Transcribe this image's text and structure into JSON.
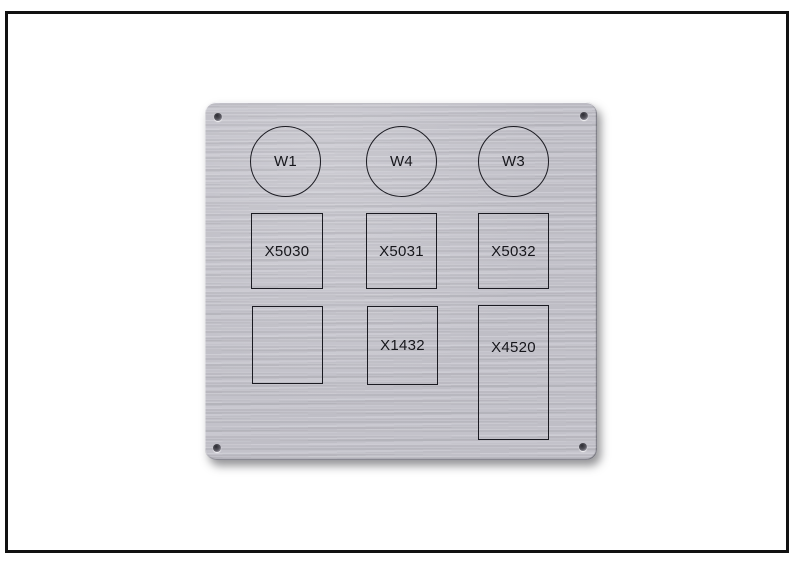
{
  "image": {
    "background_color": "#ffffff",
    "frame_color": "#111111"
  },
  "panel": {
    "material_color": "#c6c5cd",
    "line_color": "#1b1b22",
    "text_color": "#16161b",
    "circles": [
      {
        "label": "W1"
      },
      {
        "label": "W4"
      },
      {
        "label": "W3"
      }
    ],
    "middle_row": [
      {
        "label": "X5030"
      },
      {
        "label": "X5031"
      },
      {
        "label": "X5032"
      }
    ],
    "bottom_row": [
      {
        "label": ""
      },
      {
        "label": "X1432"
      },
      {
        "label": "X4520"
      }
    ]
  }
}
